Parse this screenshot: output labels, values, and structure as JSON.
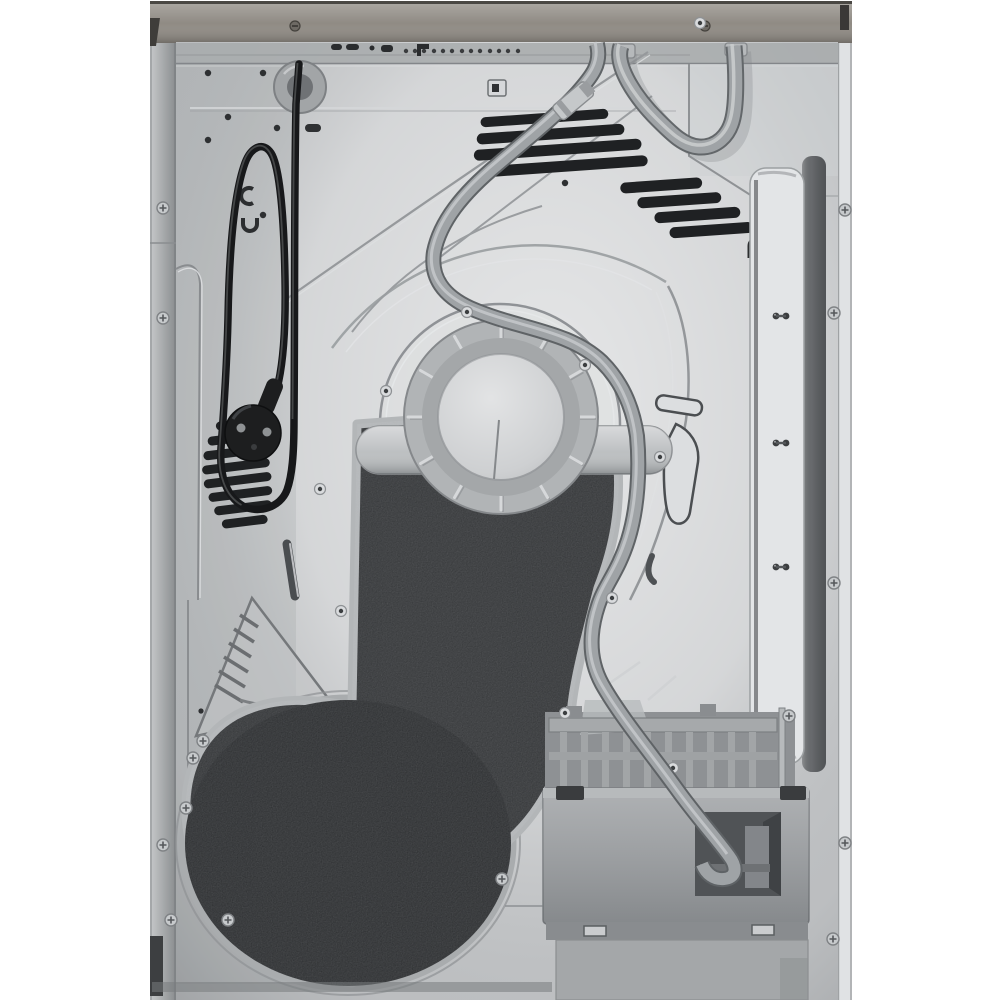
{
  "meta": {
    "subject": "tumble-dryer-rear-view",
    "view": "rear",
    "style": "studio-product-photo"
  },
  "palette": {
    "background": "#ffffff",
    "top_strip": "#8d8881",
    "edge_left": "#aeb1b3",
    "edge_right": "#e0e2e4",
    "panel": "#c7c9cb",
    "upper_band": "#a7aaac",
    "vent_slot": "#1f2123",
    "pad": "#2b2d2f",
    "drum_cover": "#232527",
    "drum_rim": "#a9acae",
    "pad_rail": "#b3b6b8",
    "hub_disc": "#cbcdcf",
    "hub_ring": "#b1b4b6",
    "axle_band": "#b9bcbe",
    "cord": "#17181a",
    "plug": "#1d1e1f",
    "hose": "#9fa3a6",
    "hose_edge": "#5f6366",
    "connector": "#c5c8ca",
    "box": "#9da0a3",
    "box_recess": "#505356",
    "channel_face": "#e3e5e7",
    "channel_groove": "#6d7073",
    "screw": "#c7cacc",
    "hole": "#2e3032"
  },
  "glyphs": {
    "channel_mark": "∩",
    "panel_marks": [
      "c",
      "∪"
    ]
  },
  "components": [
    {
      "name": "top-trim-strip"
    },
    {
      "name": "back-panel"
    },
    {
      "name": "power-cord"
    },
    {
      "name": "power-plug"
    },
    {
      "name": "cord-grommet"
    },
    {
      "name": "drain-hose"
    },
    {
      "name": "hose-connector"
    },
    {
      "name": "drum-cover-pad"
    },
    {
      "name": "drum-cover-disc"
    },
    {
      "name": "hub-disc"
    },
    {
      "name": "vent-slats-left"
    },
    {
      "name": "vent-slats-center"
    },
    {
      "name": "vent-slats-right"
    },
    {
      "name": "service-channel"
    },
    {
      "name": "condenser-box"
    },
    {
      "name": "screws"
    }
  ]
}
